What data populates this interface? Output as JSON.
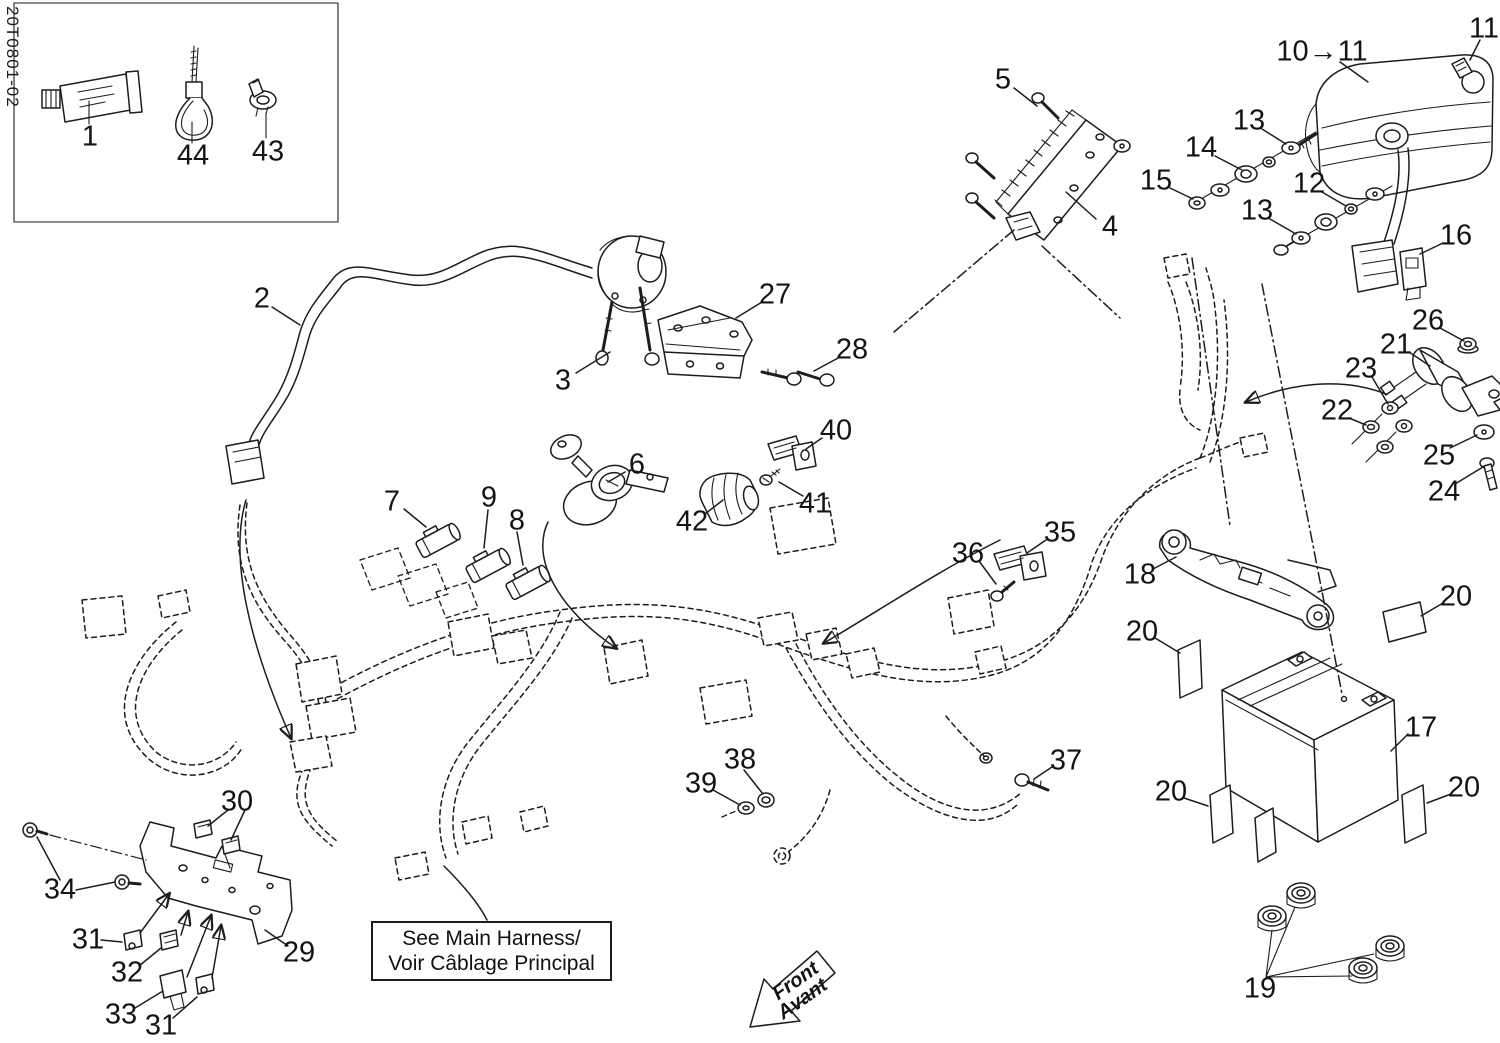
{
  "doc": {
    "drawing_code": "20T0801-02",
    "note": {
      "line1": "See Main Harness/",
      "line2": "Voir Câblage Principal"
    },
    "front_arrow": {
      "line1": "Front",
      "line2": "Avant"
    }
  },
  "labels": [
    {
      "text": "1",
      "x": 90,
      "y": 137
    },
    {
      "text": "44",
      "x": 193,
      "y": 156
    },
    {
      "text": "43",
      "x": 268,
      "y": 152
    },
    {
      "text": "2",
      "x": 262,
      "y": 299
    },
    {
      "text": "3",
      "x": 563,
      "y": 381
    },
    {
      "text": "5",
      "x": 1003,
      "y": 80
    },
    {
      "text": "4",
      "x": 1110,
      "y": 227
    },
    {
      "text": "10→11",
      "x": 1322,
      "y": 52
    },
    {
      "text": "11",
      "x": 1484,
      "y": 29
    },
    {
      "text": "13",
      "x": 1249,
      "y": 121
    },
    {
      "text": "14",
      "x": 1201,
      "y": 148
    },
    {
      "text": "15",
      "x": 1156,
      "y": 181
    },
    {
      "text": "12",
      "x": 1309,
      "y": 184
    },
    {
      "text": "13",
      "x": 1257,
      "y": 211
    },
    {
      "text": "16",
      "x": 1456,
      "y": 236
    },
    {
      "text": "26",
      "x": 1428,
      "y": 321
    },
    {
      "text": "21",
      "x": 1396,
      "y": 345
    },
    {
      "text": "23",
      "x": 1361,
      "y": 369
    },
    {
      "text": "22",
      "x": 1337,
      "y": 411
    },
    {
      "text": "25",
      "x": 1439,
      "y": 456
    },
    {
      "text": "24",
      "x": 1444,
      "y": 492
    },
    {
      "text": "27",
      "x": 775,
      "y": 295
    },
    {
      "text": "28",
      "x": 852,
      "y": 350
    },
    {
      "text": "40",
      "x": 836,
      "y": 431
    },
    {
      "text": "41",
      "x": 815,
      "y": 504
    },
    {
      "text": "42",
      "x": 692,
      "y": 522
    },
    {
      "text": "6",
      "x": 637,
      "y": 465
    },
    {
      "text": "7",
      "x": 392,
      "y": 502
    },
    {
      "text": "9",
      "x": 489,
      "y": 498
    },
    {
      "text": "8",
      "x": 517,
      "y": 521
    },
    {
      "text": "35",
      "x": 1060,
      "y": 533
    },
    {
      "text": "36",
      "x": 968,
      "y": 554
    },
    {
      "text": "18",
      "x": 1140,
      "y": 575
    },
    {
      "text": "20",
      "x": 1142,
      "y": 632
    },
    {
      "text": "20",
      "x": 1456,
      "y": 597
    },
    {
      "text": "17",
      "x": 1421,
      "y": 728
    },
    {
      "text": "20",
      "x": 1171,
      "y": 792
    },
    {
      "text": "20",
      "x": 1464,
      "y": 788
    },
    {
      "text": "19",
      "x": 1260,
      "y": 989
    },
    {
      "text": "37",
      "x": 1066,
      "y": 761
    },
    {
      "text": "38",
      "x": 740,
      "y": 760
    },
    {
      "text": "39",
      "x": 701,
      "y": 784
    },
    {
      "text": "30",
      "x": 237,
      "y": 802
    },
    {
      "text": "34",
      "x": 60,
      "y": 890
    },
    {
      "text": "31",
      "x": 88,
      "y": 940
    },
    {
      "text": "32",
      "x": 127,
      "y": 973
    },
    {
      "text": "33",
      "x": 121,
      "y": 1015
    },
    {
      "text": "31",
      "x": 161,
      "y": 1026
    },
    {
      "text": "29",
      "x": 299,
      "y": 953
    }
  ]
}
